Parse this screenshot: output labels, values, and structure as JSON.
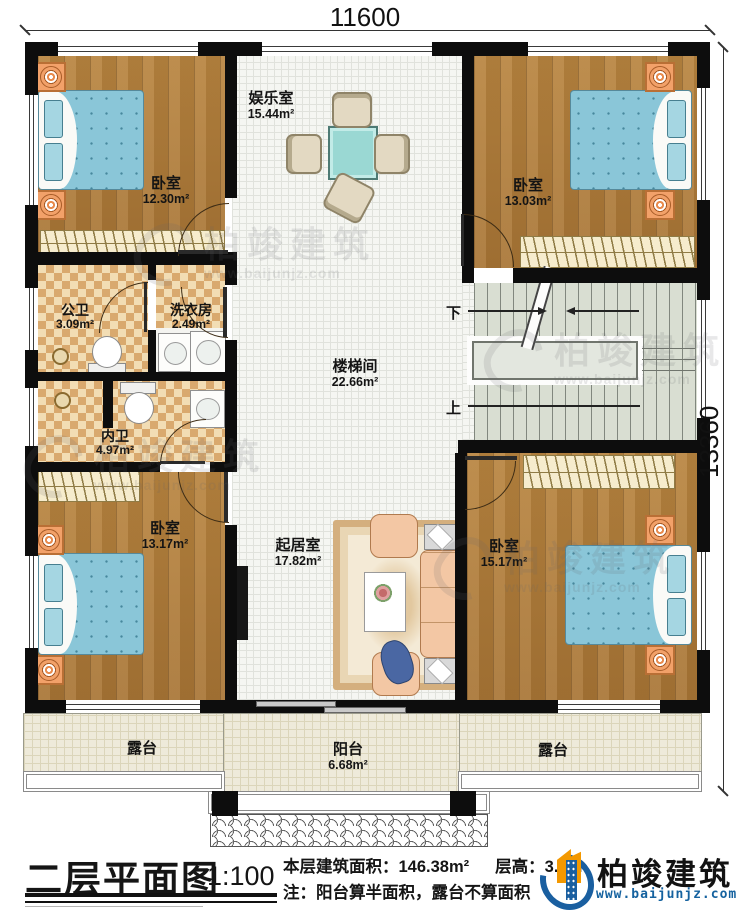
{
  "dimensions": {
    "top": "11600",
    "right": "13360"
  },
  "rooms": {
    "entertainment": {
      "name": "娱乐室",
      "area": "15.44m²"
    },
    "bedroom_tl": {
      "name": "卧室",
      "area": "12.30m²"
    },
    "bedroom_tr": {
      "name": "卧室",
      "area": "13.03m²"
    },
    "public_bath": {
      "name": "公卫",
      "area": "3.09m²"
    },
    "laundry": {
      "name": "洗衣房",
      "area": "2.49m²"
    },
    "stairwell": {
      "name": "楼梯间",
      "area": "22.66m²"
    },
    "private_bath": {
      "name": "内卫",
      "area": "4.97m²"
    },
    "bedroom_bl": {
      "name": "卧室",
      "area": "13.17m²"
    },
    "bedroom_br": {
      "name": "卧室",
      "area": "15.17m²"
    },
    "living": {
      "name": "起居室",
      "area": "17.82m²"
    },
    "terrace_left": {
      "name": "露台"
    },
    "terrace_right": {
      "name": "露台"
    },
    "balcony": {
      "name": "阳台",
      "area": "6.68m²"
    }
  },
  "stairs": {
    "down": "下",
    "up": "上"
  },
  "footer": {
    "title": "二层平面图",
    "scale": "1:100",
    "area_text": "本层建筑面积：146.38m²",
    "height_text": "层高：3.3m",
    "note": "注：阳台算半面积，露台不算面积"
  },
  "brand": {
    "name": "柏竣建筑",
    "url": "www.baijunjz.com",
    "blue": "#1a5fa0",
    "orange": "#f39800"
  },
  "watermark": {
    "name": "柏竣建筑",
    "url": "www.baijunjz.com"
  }
}
